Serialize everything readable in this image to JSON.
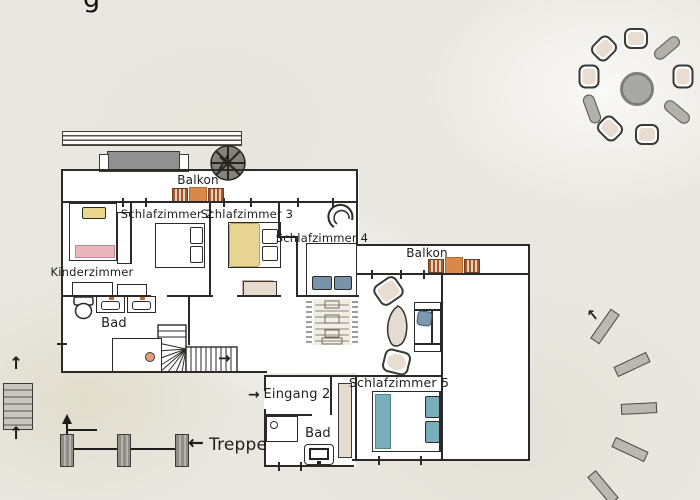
{
  "page": {
    "partial_title_glyph": "g"
  },
  "labels": {
    "balkon_upper": "Balkon",
    "schlafzimmer_2": "Schlafzimmer 2",
    "schlafzimmer_3": "Schlafzimmer 3",
    "schlafzimmer_4": "Schlafzimmer 4",
    "schlafzimmer_5": "Schlafzimmer 5",
    "kinderzimmer": "Kinderzimmer",
    "bad_upper": "Bad",
    "balkon_wing": "Balkon",
    "eingang_2": "Eingang 2",
    "bad_lower": "Bad",
    "treppe": "Treppe"
  },
  "arrows": {
    "eingang": "→",
    "stair_exit": "→",
    "treppe": "←",
    "exterior_stair_upper": "↑",
    "exterior_stair_lower": "↑",
    "garden_path": "↑",
    "stepping_stones": "↑"
  },
  "colors": {
    "wall": "#2a2a28",
    "bench_orange": "#d9884a",
    "bench_stripe_brown": "#a05a32",
    "bed_teal": "#79aebc",
    "pillow_blue": "#7b93aa",
    "pillow_yellow": "#e9d88e",
    "blanket_yellow": "#e7d495",
    "blanket_pink": "#eab6bd",
    "rug_pink": "#e8cbc6",
    "furniture_beige": "#e6dbcc",
    "newel_orange": "#e89f76",
    "faucet_orange": "#c06a3a",
    "table_gray": "#a8a8a4",
    "stone_gray": "#b9b8b2"
  },
  "outdoor": {
    "dining_chairs": 6,
    "garden_benches": 3,
    "stepping_stones": 5
  }
}
